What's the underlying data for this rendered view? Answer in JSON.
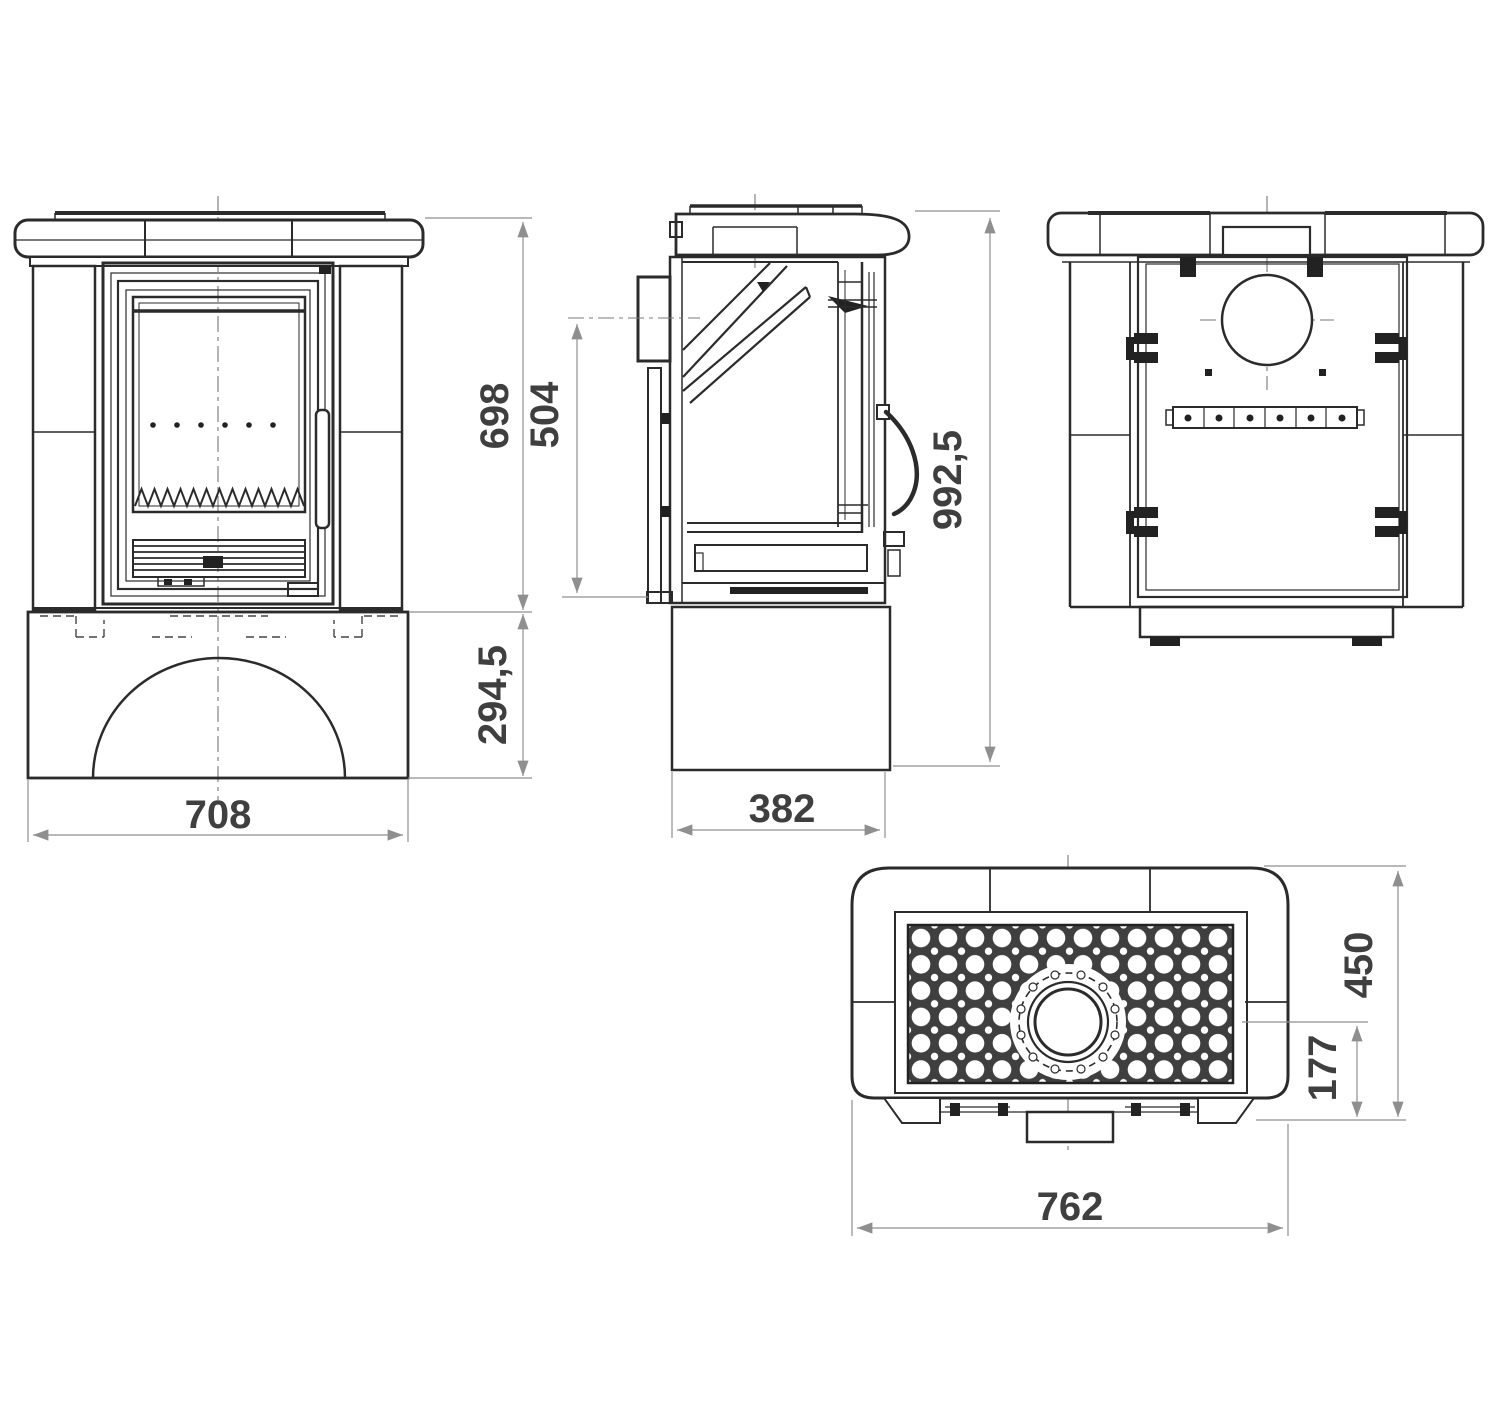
{
  "drawing": {
    "type": "technical-drawing",
    "views": {
      "front": {
        "title": "front-view",
        "dims": {
          "upper_height": "698",
          "base_height": "294,5",
          "width": "708"
        }
      },
      "side": {
        "title": "side-view",
        "dims": {
          "intake_height": "504",
          "total_height": "992,5",
          "base_depth": "382"
        }
      },
      "back": {
        "title": "back-view"
      },
      "top": {
        "title": "top-view",
        "dims": {
          "depth": "450",
          "flue_offset": "177",
          "width": "762"
        }
      }
    },
    "colors": {
      "line": "#2b2b2b",
      "dim_line": "#8f8f8f",
      "text": "#3f3f3f",
      "grille_dark": "#3f3f3f",
      "background": "#ffffff"
    }
  }
}
